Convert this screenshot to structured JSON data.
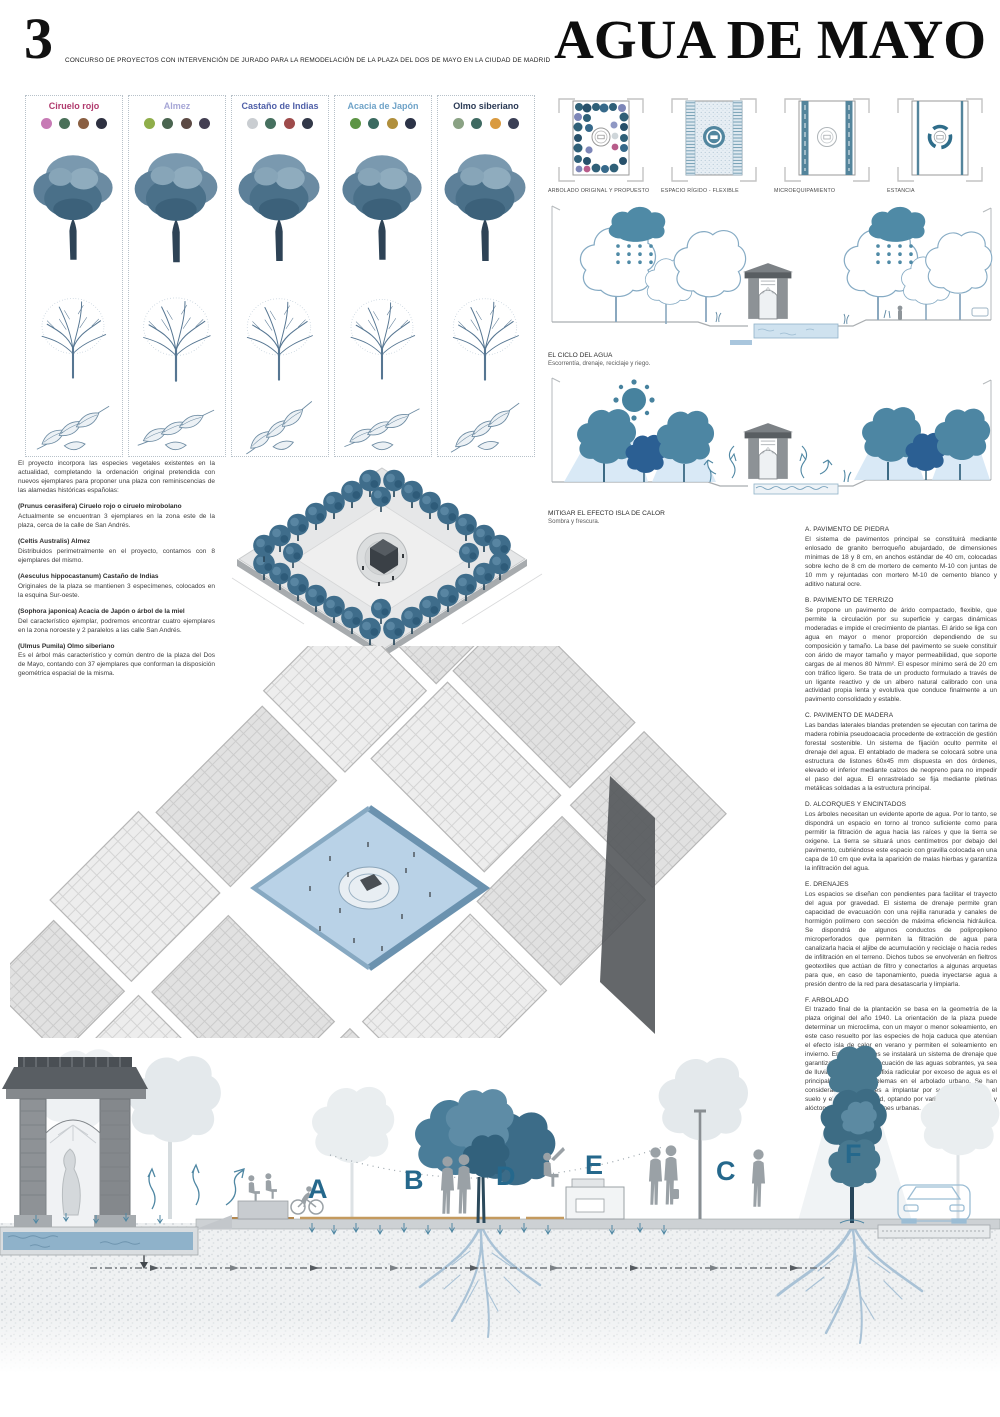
{
  "header": {
    "number": "3",
    "competition_line": "CONCURSO DE PROYECTOS CON INTERVENCIÓN DE JURADO PARA LA REMODELACIÓN DE LA PLAZA DEL DOS DE MAYO EN LA CIUDAD DE MADRID",
    "title": "AGUA DE MAYO"
  },
  "species": [
    {
      "name": "Ciruelo rojo",
      "title_color": "#b03a6d",
      "dots": [
        "#c77ab5",
        "#4a7059",
        "#8a5f42",
        "#2e3141"
      ]
    },
    {
      "name": "Almez",
      "title_color": "#a6a6d6",
      "dots": [
        "#8fae4a",
        "#4a6550",
        "#5c4a44",
        "#433f52"
      ]
    },
    {
      "name": "Castaño de Indias",
      "title_color": "#4f5fa8",
      "dots": [
        "#c9cdd1",
        "#46705f",
        "#9e4b4b",
        "#323848"
      ]
    },
    {
      "name": "Acacia de Japón",
      "title_color": "#6fa3c8",
      "dots": [
        "#5c9444",
        "#3a6a60",
        "#b08f3c",
        "#2c3347"
      ]
    },
    {
      "name": "Olmo siberiano",
      "title_color": "#2b3a55",
      "dots": [
        "#8aa284",
        "#3f6a62",
        "#d99a3f",
        "#3a3f55"
      ]
    }
  ],
  "plan_labels": [
    "ARBOLADO ORIGINAL Y PROPUESTO",
    "ESPACIO RÍGIDO - FLEXIBLE",
    "MICROEQUIPAMIENTO",
    "ESTANCIA"
  ],
  "diagrams": [
    {
      "title": "EL CICLO DEL AGUA",
      "subtitle": "Escorrentía, drenaje, reciclaje y riego."
    },
    {
      "title": "MITIGAR EL EFECTO ISLA DE CALOR",
      "subtitle": "Sombra y frescura."
    }
  ],
  "left_text": {
    "intro": "El proyecto incorpora las especies vegetales existentes en la actualidad, completando la ordenación original pretendida con nuevos ejemplares para proponer una plaza con reminiscencias de las alamedas históricas españolas:",
    "notes": [
      {
        "heading": "(Prunus cerasifera) Ciruelo rojo o ciruelo mirobolano",
        "body": "Actualmente se encuentran 3 ejemplares en la zona este de la plaza, cerca de la calle de San Andrés."
      },
      {
        "heading": "(Celtis Australis) Almez",
        "body": "Distribuidos perimetralmente en el proyecto, contamos con 8 ejemplares del mismo."
      },
      {
        "heading": "(Aesculus hippocastanum) Castaño de Indias",
        "body": "Originales de la plaza se mantienen 3 especímenes, colocados en la esquina Sur-oeste."
      },
      {
        "heading": "(Sophora japonica) Acacia de Japón o árbol de la miel",
        "body": "Del característico ejemplar, podremos encontrar cuatro ejemplares en la zona noroeste y 2 paralelos a las calle San Andrés."
      },
      {
        "heading": "(Ulmus Pumila) Olmo siberiano",
        "body": "Es el árbol más característico y común dentro de la plaza del Dos de Mayo, contando con 37 ejemplares que conforman la disposición geométrica espacial de la misma."
      }
    ]
  },
  "spec_sections": [
    {
      "title": "A. PAVIMENTO DE PIEDRA",
      "body": "El sistema de pavimentos principal se constituirá mediante enlosado de granito berroqueño abujardado, de dimensiones mínimas de 18 y 8 cm, en anchos estándar de 40 cm, colocadas sobre lecho de 8 cm de mortero de cemento M-10 con juntas de 10 mm y rejuntadas con mortero M-10 de cemento blanco y aditivo natural ocre."
    },
    {
      "title": "B. PAVIMENTO DE TERRIZO",
      "body": "Se propone un pavimento de árido compactado, flexible, que permite la circulación por su superficie y cargas dinámicas moderadas e impide el crecimiento de plantas. El árido se liga con agua en mayor o menor proporción dependiendo de su composición y tamaño. La base del pavimento se suele constituir con árido de mayor tamaño y mayor permeabilidad, que soporte cargas de al menos 80 N/mm². El espesor mínimo será de 20 cm con tráfico ligero. Se trata de un producto formulado a través de un ligante reactivo y de un albero natural calibrado con una actividad propia lenta y evolutiva que conduce finalmente a un pavimento consolidado y estable."
    },
    {
      "title": "C. PAVIMENTO DE MADERA",
      "body": "Las bandas laterales blandas pretenden se ejecutan con tarima de madera robinia pseudoacacia procedente de extracción de gestión forestal sostenible. Un sistema de fijación oculto permite el drenaje del agua. El entablado de madera se colocará sobre una estructura de listones 60x45 mm dispuesta en dos órdenes, elevado el inferior mediante calzos de neopreno para no impedir el paso del agua. El enrastrelado se fija mediante pletinas metálicas soldadas a la estructura principal."
    },
    {
      "title": "D. ALCORQUES Y ENCINTADOS",
      "body": "Los árboles necesitan un evidente aporte de agua. Por lo tanto, se dispondrá un espacio en torno al tronco suficiente como para permitir la filtración de agua hacia las raíces y que la tierra se oxigene. La tierra se situará unos centímetros por debajo del pavimento, cubriéndose este espacio con gravilla colocada en una capa de 10 cm que evita la aparición de malas hierbas y garantiza la infiltración del agua."
    },
    {
      "title": "E. DRENAJES",
      "body": "Los espacios se diseñan con pendientes para facilitar el trayecto del agua por gravedad. El sistema de drenaje permite gran capacidad de evacuación con una rejilla ranurada y canales de hormigón polímero con sección de máxima eficiencia hidráulica. Se dispondrá de algunos conductos de polipropileno microperforados que permiten la filtración de agua para canalizarla hacia el aljibe de acumulación y reciclaje o hacia redes de infiltración en el terreno. Dichos tubos se envolverán en fieltros geotextiles que actúan de filtro y conectarlos a algunas arquetas para que, en caso de taponamiento, pueda inyectarse agua a presión dentro de la red para desatascarla y limpiarla."
    },
    {
      "title": "F. ARBOLADO",
      "body": "El trazado final de la plantación se basa en la geometría de la plaza original del año 1940. La orientación de la plaza puede determinar un microclima, con un mayor o menor soleamiento, en este caso resuelto por las especies de hoja caduca que atenúan el efecto isla de calor en verano y permiten el soleamiento en invierno. En los alcorques se instalará un sistema de drenaje que garantiza la adecuada evacuación de las aguas sobrantes, ya sea de lluvia o de riego. La asfixia radicular por exceso de agua es el principal motivo de problemas en el arbolado urbano. Se han considerado las especies a implantar por su idoneidad con el suelo y el clima de Madrid, optando por variedades autóctonas y alóctonas para las condiciones urbanas."
    }
  ],
  "markers": {
    "a": "A",
    "b": "B",
    "c": "C",
    "d": "D",
    "e": "E",
    "f": "F"
  },
  "accent_colors": {
    "marker_teal": "#25688c",
    "tree_teal": "#4a7d99",
    "dark_blue": "#2b5f93",
    "water_blue": "#8fb2ca",
    "plaza_blue": "#b9d2e7"
  }
}
